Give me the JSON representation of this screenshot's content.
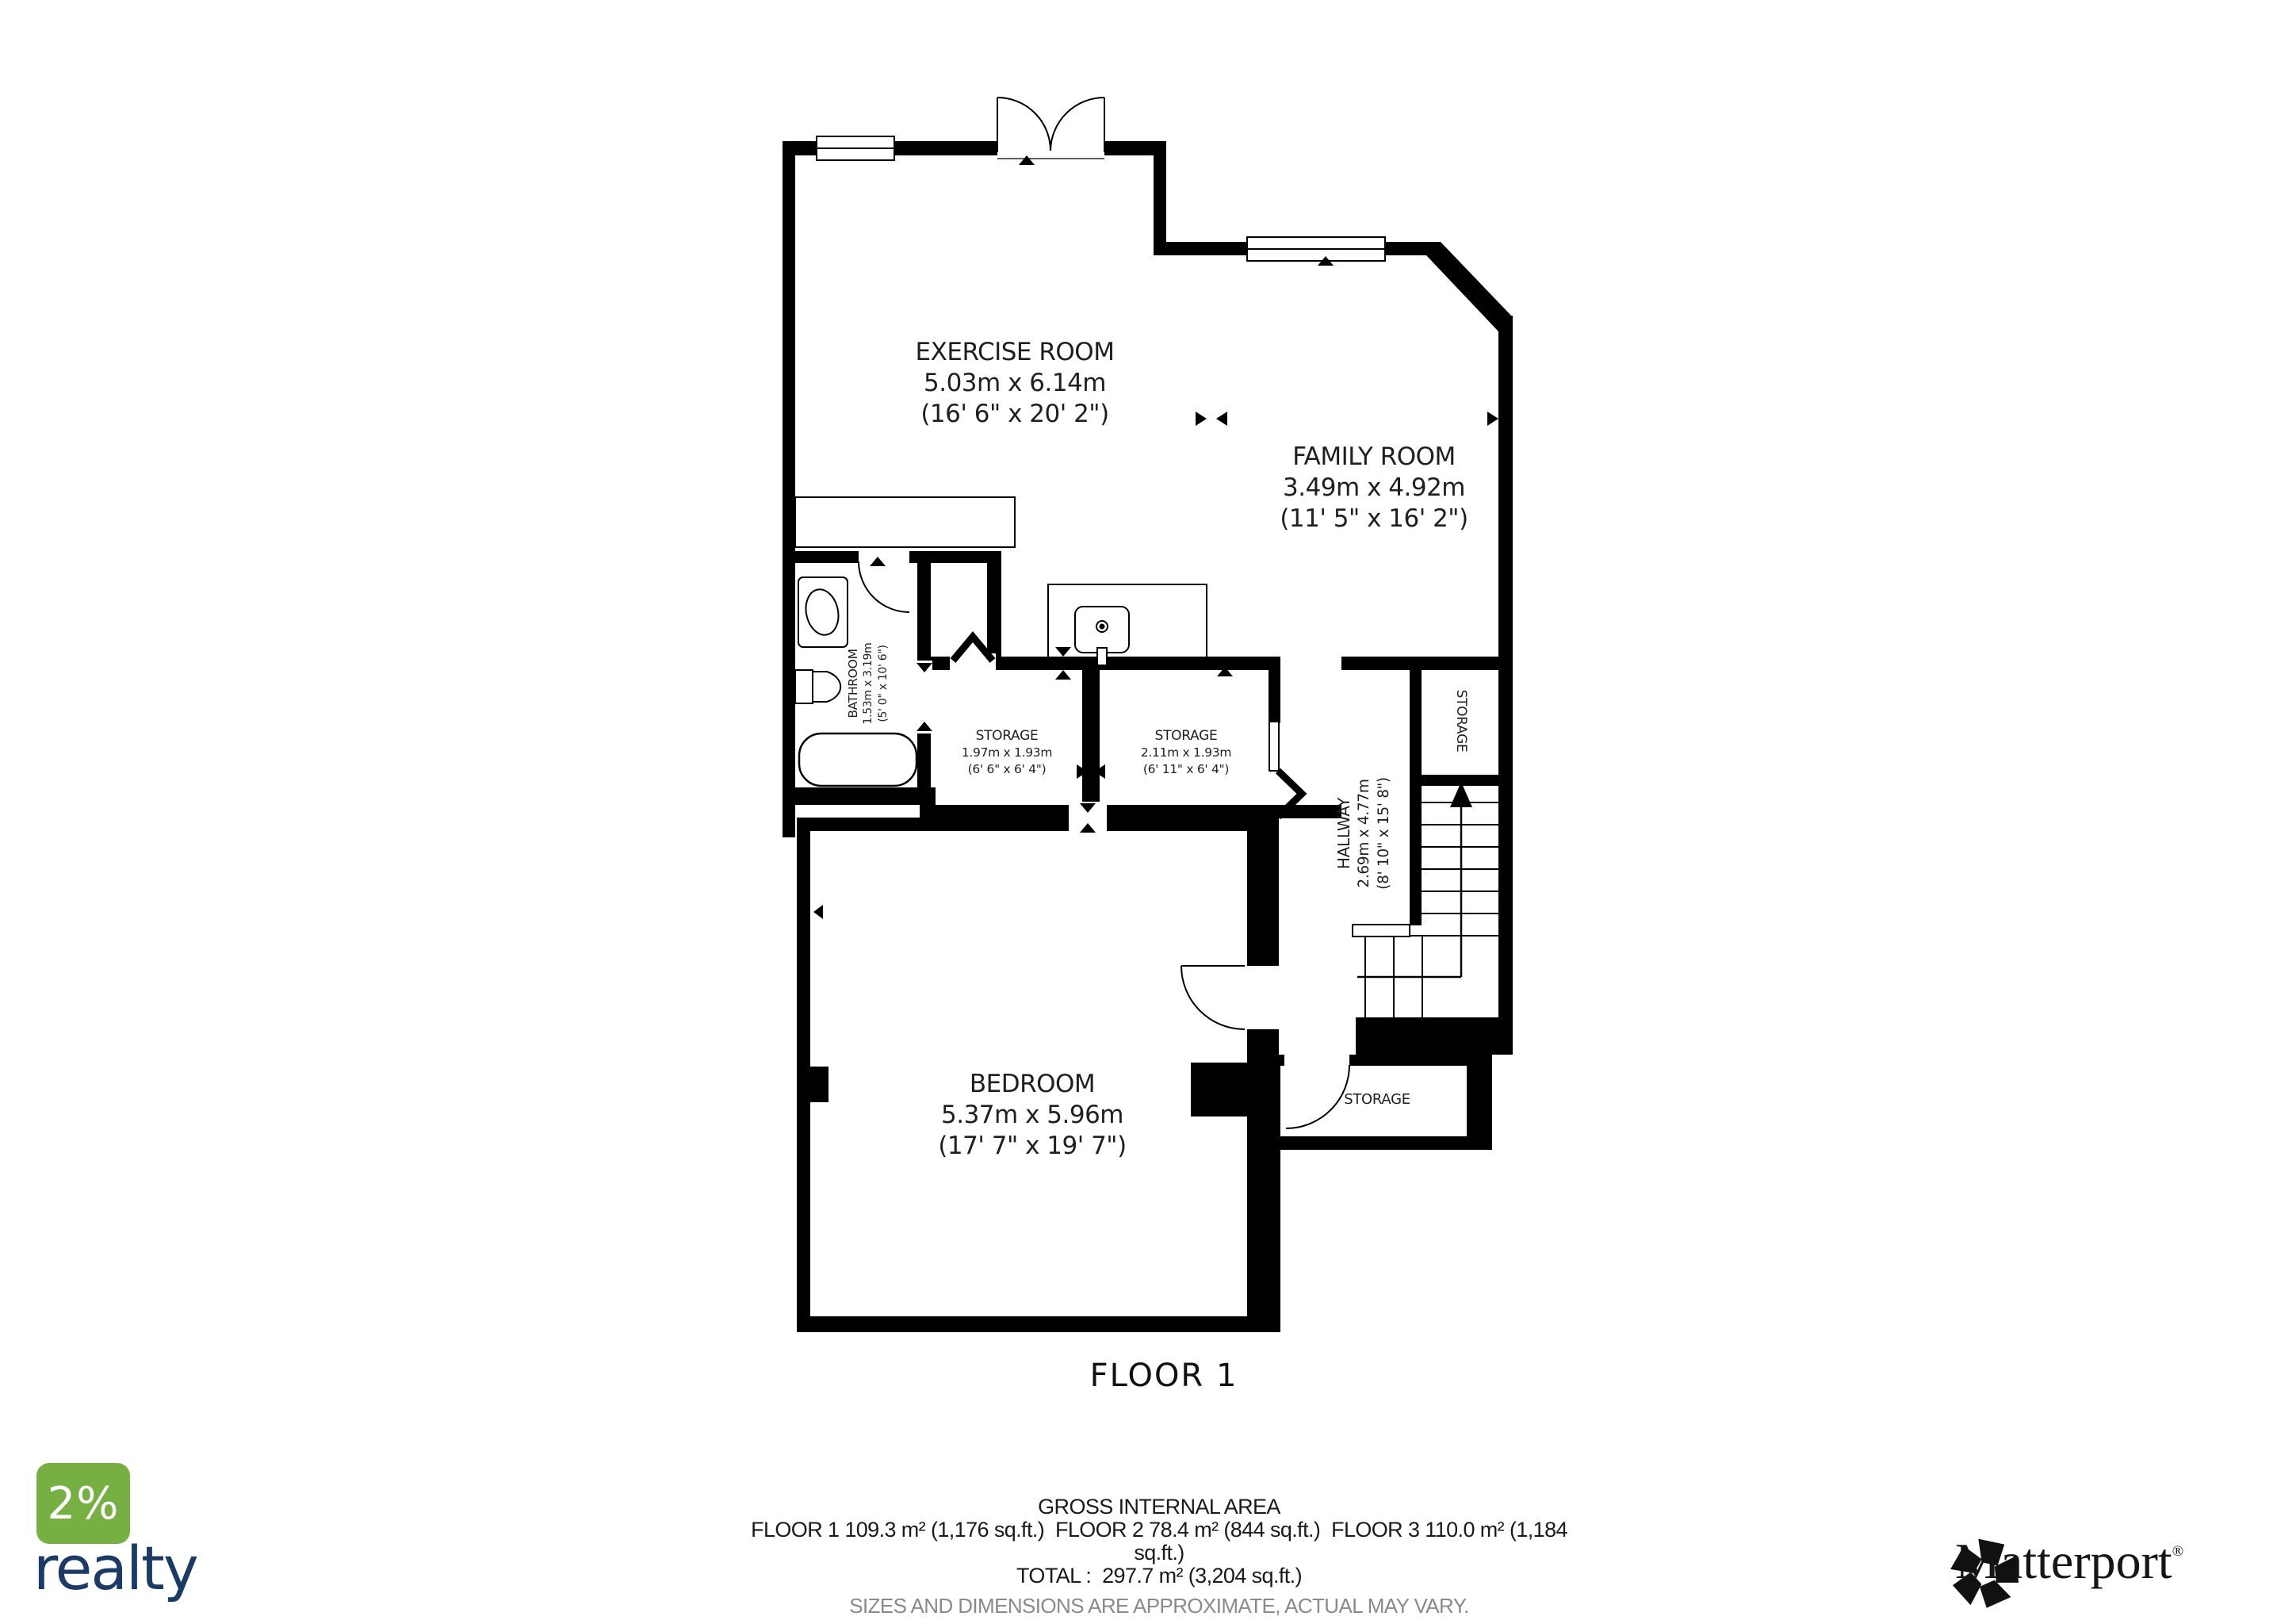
{
  "title": "FLOOR 1",
  "rooms": {
    "exercise": {
      "name": "EXERCISE ROOM",
      "metric": "5.03m x 6.14m",
      "imperial": "(16' 6\" x 20' 2\")"
    },
    "family": {
      "name": "FAMILY ROOM",
      "metric": "3.49m x 4.92m",
      "imperial": "(11' 5\" x 16' 2\")"
    },
    "bathroom": {
      "name": "BATHROOM",
      "metric": "1.53m x 3.19m",
      "imperial": "(5' 0\" x 10' 6\")"
    },
    "storage1": {
      "name": "STORAGE",
      "metric": "1.97m x 1.93m",
      "imperial": "(6' 6\" x 6' 4\")"
    },
    "storage2": {
      "name": "STORAGE",
      "metric": "2.11m x 1.93m",
      "imperial": "(6' 11\" x 6' 4\")"
    },
    "hallway": {
      "name": "HALLWAY",
      "metric": "2.69m x 4.77m",
      "imperial": "(8' 10\" x 15' 8\")"
    },
    "storage_right": {
      "name": "STORAGE"
    },
    "storage_bottom": {
      "name": "STORAGE"
    },
    "bedroom": {
      "name": "BEDROOM",
      "metric": "5.37m x 5.96m",
      "imperial": "(17' 7\" x 19' 7\")"
    }
  },
  "footer": {
    "heading": "GROSS INTERNAL AREA",
    "areas_line1": "FLOOR 1 109.3 m² (1,176 sq.ft.)  FLOOR 2 78.4 m² (844 sq.ft.)  FLOOR 3 110.0 m² (1,184",
    "areas_line2": "sq.ft.)",
    "total": "TOTAL :  297.7 m² (3,204 sq.ft.)",
    "disclaimer": "SIZES AND DIMENSIONS ARE APPROXIMATE, ACTUAL MAY VARY."
  },
  "branding": {
    "realty_percent": "2%",
    "realty_word": "realty",
    "realty_green": "#76B043",
    "realty_navy": "#1B3A66",
    "matterport_word": "Matterport",
    "registered_mark": "®"
  }
}
